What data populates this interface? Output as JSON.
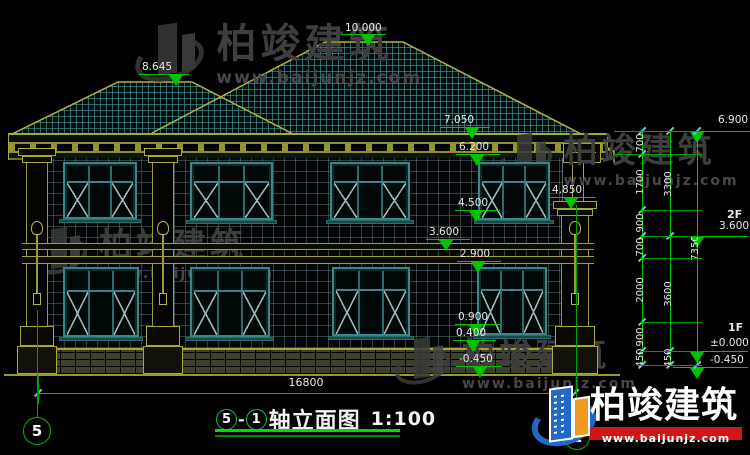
{
  "meta": {
    "drawing_type": "house elevation CAD drawing"
  },
  "title_bar": {
    "axis_a": "5",
    "dash": "-",
    "axis_b": "1",
    "title": "轴立面图",
    "scale": "1:100"
  },
  "watermark": {
    "brand": "柏竣建筑",
    "url": "www.baijunjz.com"
  },
  "brand_logo": {
    "brand": "柏竣建筑",
    "url": "www.baijunjz.com",
    "x": 533,
    "y": 383
  },
  "colors": {
    "line_yellow": "#a8a838",
    "dim_green": "#00c400",
    "tick_cyan": "#58d0d0",
    "text_white": "#e8e8e8",
    "frame_teal": "#3a8585",
    "mullion_teal": "#2a6b6b",
    "glass_dark": "#010808",
    "xline_gray": "#9fb6b6",
    "watermark_gray": "#3e3e3e",
    "logo_blue": "#2268c8",
    "logo_orange": "#f09a20",
    "logo_red": "#cf1717"
  },
  "annotations": {
    "elevation_markers": [
      {
        "label": "10.000",
        "tx": 345,
        "ty": 23,
        "lx": 342,
        "ly": 34,
        "lw": 44,
        "ax": 368
      },
      {
        "label": "8.645",
        "tx": 142,
        "ty": 62,
        "lx": 139,
        "ly": 74,
        "lw": 50,
        "ax": 176
      },
      {
        "label": "7.050",
        "tx": 444,
        "ty": 115,
        "lx": 441,
        "ly": 127,
        "lw": 49,
        "ax": 472
      },
      {
        "label": "6.200",
        "tx": 459,
        "ty": 142,
        "lx": 456,
        "ly": 154,
        "lw": 44,
        "ax": 477
      },
      {
        "label": "4.500",
        "tx": 458,
        "ty": 198,
        "lx": 455,
        "ly": 210,
        "lw": 45,
        "ax": 476
      },
      {
        "label": "4.850",
        "tx": 552,
        "ty": 185,
        "lx": 549,
        "ly": 197,
        "lw": 47,
        "ax": 571
      },
      {
        "label": "3.600",
        "tx": 429,
        "ty": 227,
        "lx": 426,
        "ly": 239,
        "lw": 44,
        "ax": 446
      },
      {
        "label": "2.900",
        "tx": 460,
        "ty": 249,
        "lx": 457,
        "ly": 261,
        "lw": 44,
        "ax": 478
      },
      {
        "label": "0.900",
        "tx": 458,
        "ty": 312,
        "lx": 455,
        "ly": 324,
        "lw": 45,
        "ax": 476
      },
      {
        "label": "0.400",
        "tx": 456,
        "ty": 328,
        "lx": 453,
        "ly": 340,
        "lw": 43,
        "ax": 473
      },
      {
        "label": "-0.450",
        "tx": 459,
        "ty": 354,
        "lx": 456,
        "ly": 366,
        "lw": 46,
        "ax": 480
      },
      {
        "label": "6.900",
        "tx": 718,
        "ty": 115,
        "lx": 683,
        "ly": 131,
        "lw": 67,
        "ax": 697
      },
      {
        "label": "3.600",
        "tx": 719,
        "ty": 221,
        "lx": 673,
        "ly": 236,
        "lw": 75,
        "ax": 697
      },
      {
        "label": "±0.000",
        "tx": 710,
        "ty": 338,
        "lx": 673,
        "ly": 351,
        "lw": 75,
        "ax": 697
      },
      {
        "label": "-0.450",
        "tx": 710,
        "ty": 355,
        "lx": 673,
        "ly": 367,
        "lw": 75,
        "ax": 697
      }
    ],
    "floor_labels": [
      {
        "text": "2F",
        "x": 727,
        "y": 209
      },
      {
        "text": "1F",
        "x": 728,
        "y": 322
      }
    ],
    "dim_chains": [
      {
        "x": 642,
        "segments": [
          [
            "700",
            131,
            154
          ],
          [
            "1700",
            154,
            210
          ],
          [
            "900",
            210,
            236
          ],
          [
            "700",
            236,
            258
          ],
          [
            "2000",
            258,
            322
          ],
          [
            "900",
            322,
            351
          ],
          [
            "450",
            351,
            365
          ]
        ]
      },
      {
        "x": 670,
        "segments": [
          [
            "3300",
            131,
            236
          ],
          [
            "3600",
            236,
            351
          ],
          [
            "450",
            351,
            365
          ]
        ]
      },
      {
        "x": 697,
        "segments": [
          [
            "7350",
            131,
            365
          ]
        ]
      }
    ],
    "ext_lines": [
      [
        131,
        614,
        702
      ],
      [
        154,
        614,
        702
      ],
      [
        210,
        640,
        702
      ],
      [
        236,
        640,
        702
      ],
      [
        258,
        640,
        702
      ],
      [
        322,
        640,
        702
      ],
      [
        351,
        640,
        702
      ],
      [
        365,
        640,
        702
      ]
    ],
    "h_dim": {
      "label": "16800",
      "x1": 38,
      "x2": 575,
      "y": 393,
      "tx": 306,
      "ty": 377
    },
    "axis_bubbles": [
      {
        "label": "5",
        "cx": 37,
        "cy": 431,
        "r": 14,
        "line": [
          37,
          310,
          417
        ]
      },
      {
        "label": "1",
        "cx": 577,
        "cy": 437,
        "r": 13,
        "line": [
          576,
          205,
          424
        ]
      }
    ]
  },
  "building": {
    "windows": [
      [
        63,
        162,
        74,
        57
      ],
      [
        190,
        162,
        83,
        58
      ],
      [
        330,
        162,
        80,
        58
      ],
      [
        478,
        162,
        72,
        58
      ],
      [
        63,
        267,
        76,
        70
      ],
      [
        190,
        267,
        80,
        70
      ],
      [
        332,
        267,
        78,
        69
      ],
      [
        477,
        267,
        70,
        68
      ]
    ],
    "pilasters": [
      {
        "x": 21,
        "w": 32,
        "cap": 148
      },
      {
        "x": 147,
        "w": 32,
        "cap": 148
      },
      {
        "x": 556,
        "w": 38,
        "cap": 201
      }
    ]
  },
  "watermarks": [
    {
      "x": 136,
      "y": 22,
      "icon": 62,
      "text": 40,
      "url": 17
    },
    {
      "x": 33,
      "y": 226,
      "icon": 50,
      "text": 33,
      "url": 14
    },
    {
      "x": 500,
      "y": 132,
      "icon": 48,
      "text": 34,
      "url": 14
    },
    {
      "x": 396,
      "y": 336,
      "icon": 50,
      "text": 33,
      "url": 14
    }
  ]
}
